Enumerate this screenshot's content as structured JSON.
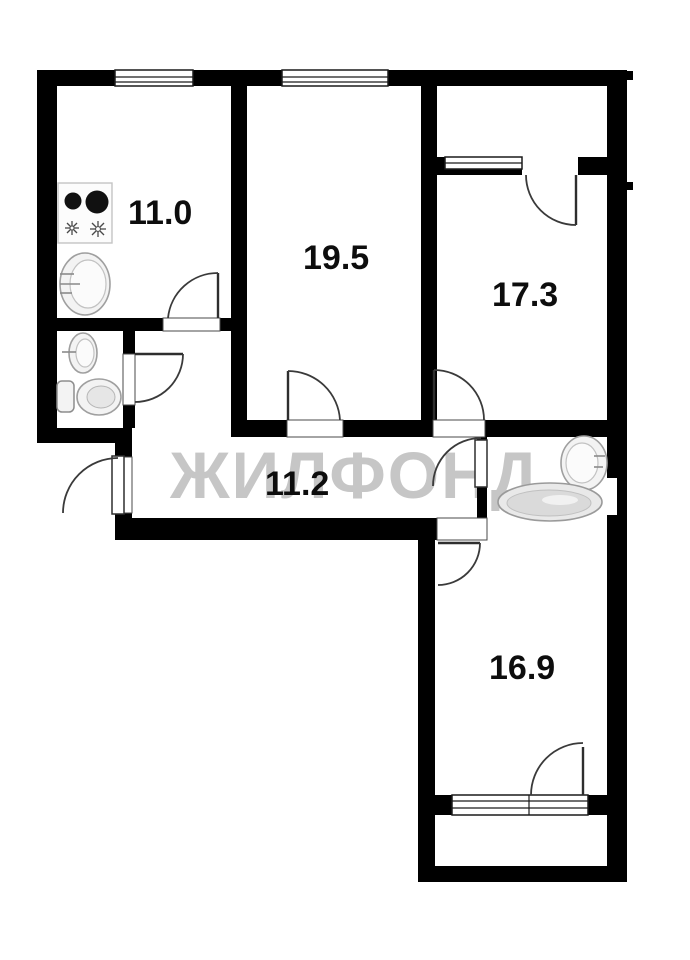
{
  "plan": {
    "watermark": "ЖИЛФОНД",
    "rooms": [
      {
        "name": "kitchen",
        "area": "11.0"
      },
      {
        "name": "living-room",
        "area": "19.5"
      },
      {
        "name": "bedroom-upper",
        "area": "17.3"
      },
      {
        "name": "hallway",
        "area": "11.2"
      },
      {
        "name": "bedroom-lower",
        "area": "16.9"
      }
    ],
    "fixtures": [
      "stove-icon",
      "kitchen-sink-icon",
      "wc-sink-icon",
      "toilet-icon",
      "bathroom-sink-icon",
      "bathtub-icon"
    ],
    "colors": {
      "walls": "#000000",
      "background": "#ffffff",
      "watermark": "#c6c6c6",
      "labels": "#0d0d0d"
    }
  }
}
